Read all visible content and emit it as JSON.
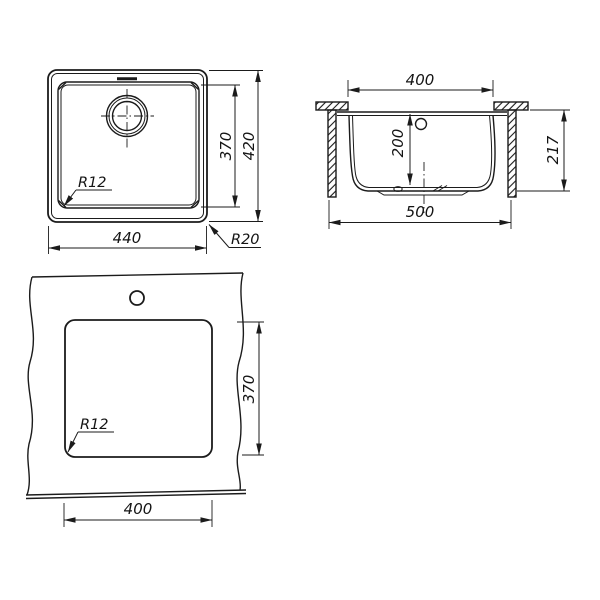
{
  "title": "Sink installation dimensions drawing",
  "colors": {
    "line": "#1b1b1b",
    "background": "#ffffff"
  },
  "views": {
    "top": {
      "width": "440",
      "bowl_height": "370",
      "height": "420",
      "corner_radius": "R12",
      "outer_radius": "R20"
    },
    "section": {
      "bowl_width": "400",
      "bowl_depth": "200",
      "height": "217",
      "overall_width": "500"
    },
    "cutout": {
      "width": "400",
      "height": "370",
      "corner_radius": "R12"
    }
  }
}
